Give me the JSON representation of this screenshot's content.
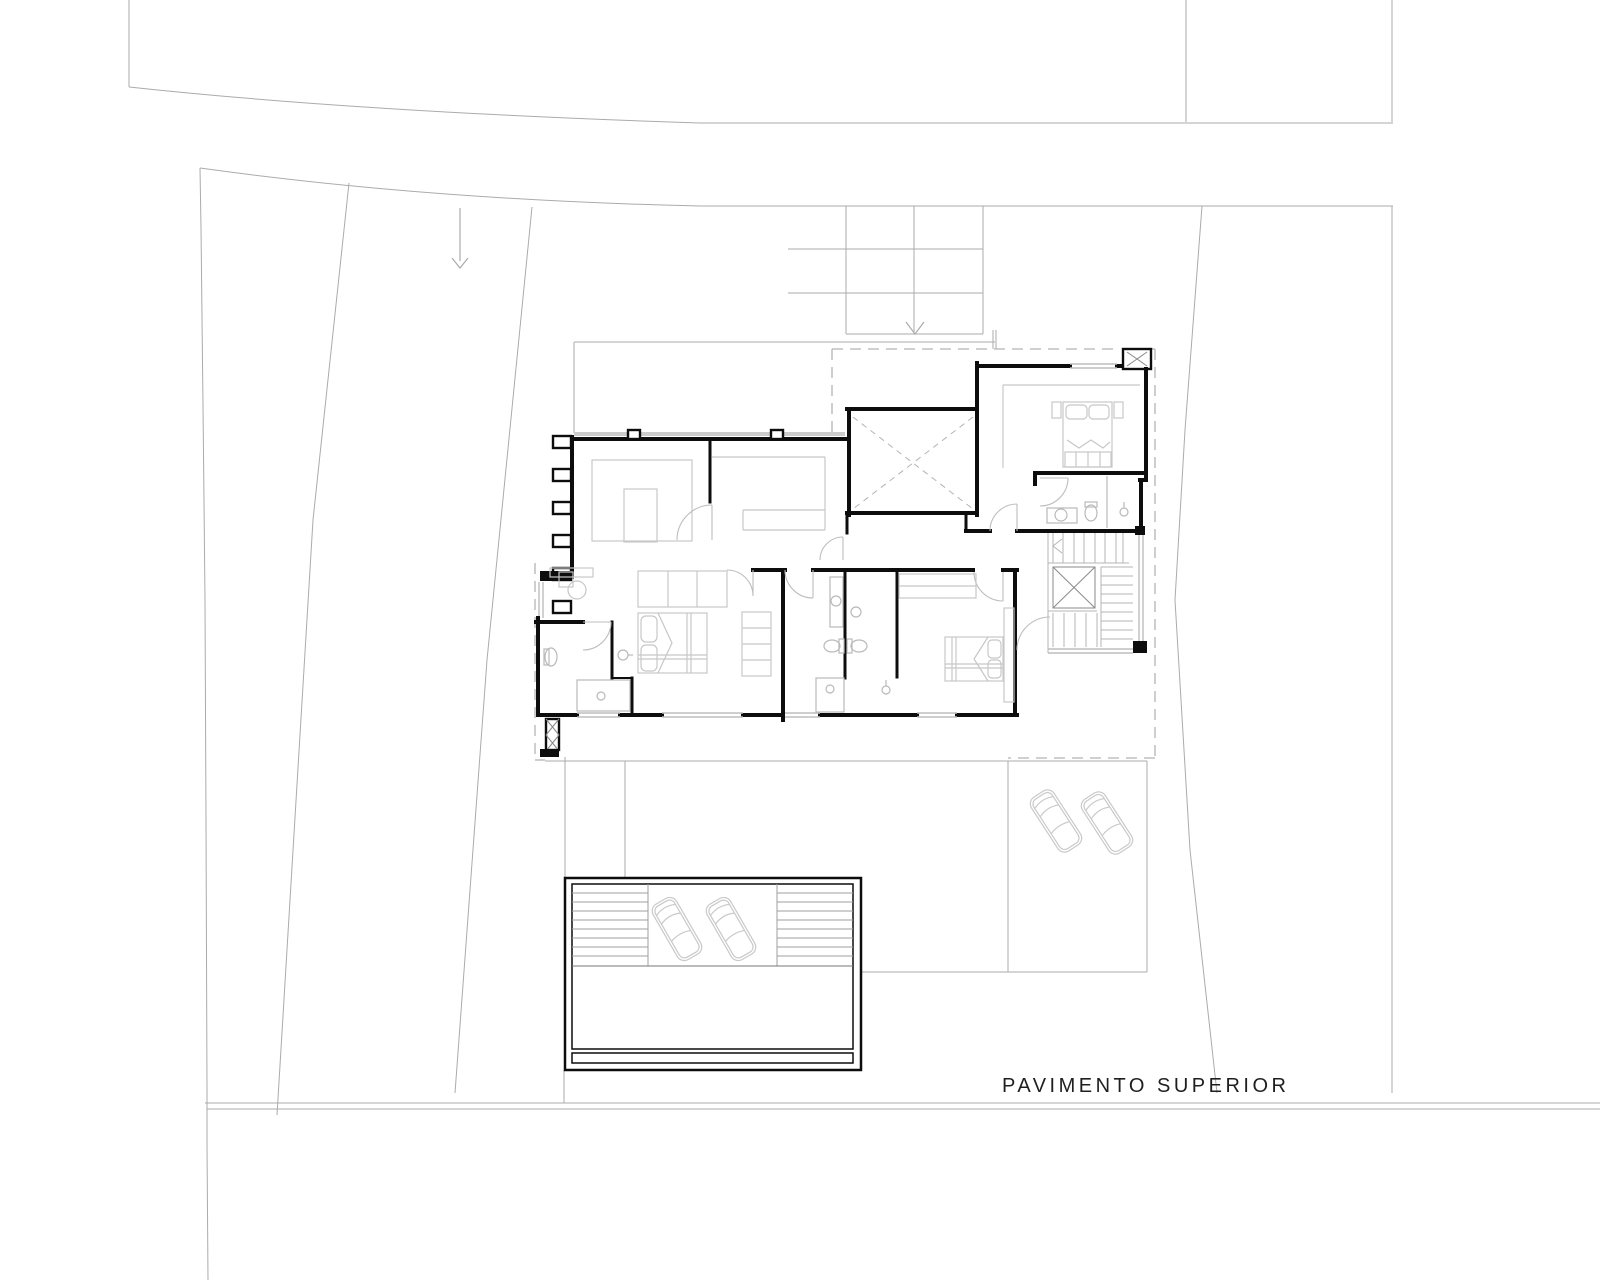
{
  "title": {
    "label": "PAVIMENTO SUPERIOR"
  },
  "drawing": {
    "kind": "architectural floor plan, upper storey site plan",
    "car_count": 4,
    "louver_fin_count": 6,
    "paving_grid": {
      "columns": 2,
      "rows": 3
    }
  },
  "colors": {
    "background": "#ffffff",
    "wall": "#0d0d0d",
    "site_line": "#ababab",
    "dashed_line": "#b3b3b3",
    "furniture": "#c7c7c7",
    "fixture": "#b9b9b9",
    "stair": "#b5b5b5",
    "window": "#bdbdbd",
    "overhang_band": "#cccccc",
    "car": "#c9c9c9",
    "text": "#1f1f1f"
  }
}
